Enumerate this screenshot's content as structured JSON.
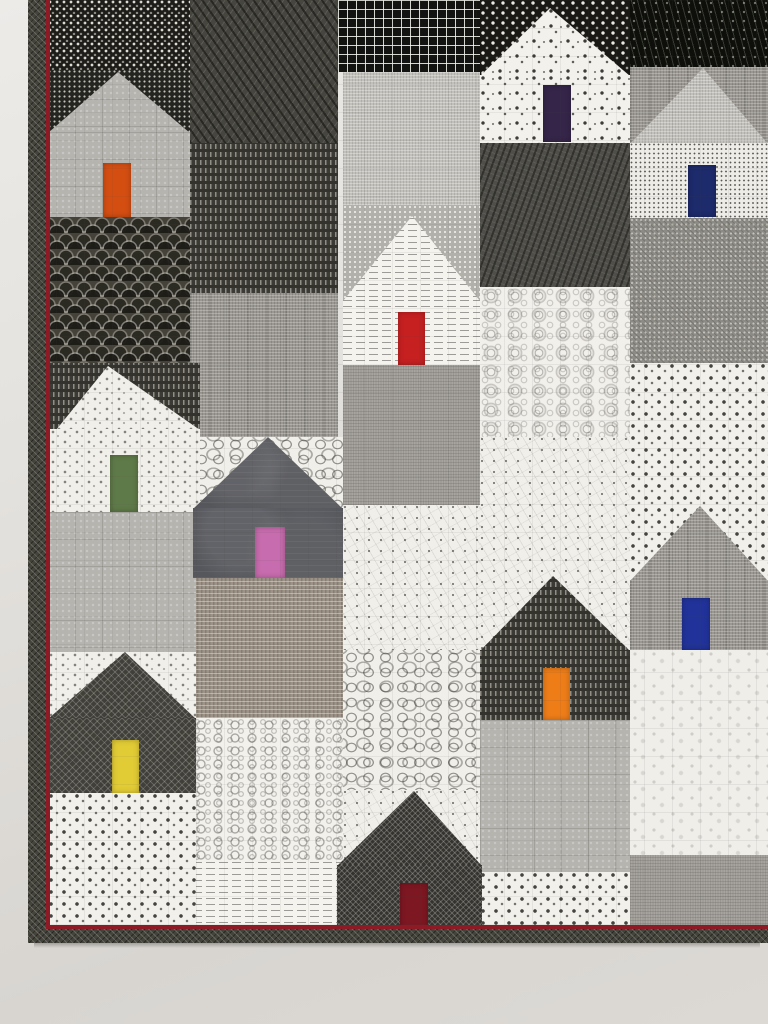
{
  "scene": {
    "subject": "Modern patchwork quilt of house blocks hanging on a gallery wall",
    "medium": "photograph",
    "houses_count": 10
  },
  "wall": {
    "top_color": "#edebe8",
    "bottom_color": "#d8d5d1"
  },
  "quilt": {
    "area": {
      "x": 28,
      "y": 0,
      "w": 740,
      "h": 943
    },
    "binding_color": "#45443c",
    "accent_color": "#8e1a26",
    "bands": [
      {
        "x": 28,
        "y": 0,
        "w": 18,
        "h": 943,
        "type": "binding",
        "name": "binding-left"
      },
      {
        "x": 28,
        "y": 929,
        "w": 740,
        "h": 14,
        "type": "binding",
        "name": "binding-bottom"
      },
      {
        "x": 46,
        "y": 0,
        "w": 4,
        "h": 929,
        "type": "accent",
        "name": "accent-line-left"
      },
      {
        "x": 46,
        "y": 925,
        "w": 722,
        "h": 4,
        "type": "accent",
        "name": "accent-line-bottom"
      },
      {
        "x": 34,
        "y": 943,
        "w": 726,
        "h": 5,
        "type": "shadow",
        "name": "quilt-drop-shadow"
      }
    ],
    "patches": [
      {
        "x": 630,
        "y": 0,
        "w": 138,
        "h": 67,
        "f": "bk_speck"
      },
      {
        "x": 630,
        "y": 67,
        "w": 138,
        "h": 76,
        "f": "md_linen"
      },
      {
        "x": 630,
        "y": 218,
        "w": 138,
        "h": 145,
        "f": "gray_dg"
      },
      {
        "x": 630,
        "y": 363,
        "w": 138,
        "h": 217,
        "f": "w_sqdots"
      },
      {
        "x": 630,
        "y": 650,
        "w": 138,
        "h": 205,
        "f": "w_floral"
      },
      {
        "x": 630,
        "y": 855,
        "w": 138,
        "h": 75,
        "f": "gray_scr"
      },
      {
        "x": 480,
        "y": 0,
        "w": 150,
        "h": 75,
        "f": "bk_sqbig"
      },
      {
        "x": 480,
        "y": 143,
        "w": 150,
        "h": 144,
        "f": "dk_slab"
      },
      {
        "x": 480,
        "y": 287,
        "w": 150,
        "h": 150,
        "f": "w_swirl"
      },
      {
        "x": 480,
        "y": 437,
        "w": 150,
        "h": 215,
        "f": "w_tri"
      },
      {
        "x": 480,
        "y": 720,
        "w": 150,
        "h": 152,
        "f": "lt_grid"
      },
      {
        "x": 480,
        "y": 872,
        "w": 150,
        "h": 58,
        "f": "w_sqdots"
      },
      {
        "x": 338,
        "y": 0,
        "w": 142,
        "h": 72,
        "f": "bk_grid"
      },
      {
        "x": 343,
        "y": 72,
        "w": 137,
        "h": 133,
        "f": "lt_linen"
      },
      {
        "x": 343,
        "y": 205,
        "w": 137,
        "h": 97,
        "f": "gray_dots"
      },
      {
        "x": 343,
        "y": 365,
        "w": 137,
        "h": 140,
        "f": "gray_scr"
      },
      {
        "x": 343,
        "y": 505,
        "w": 137,
        "h": 145,
        "f": "w_tri"
      },
      {
        "x": 343,
        "y": 650,
        "w": 137,
        "h": 143,
        "f": "w_sqout"
      },
      {
        "x": 343,
        "y": 790,
        "w": 137,
        "h": 80,
        "f": "w_tri"
      },
      {
        "x": 190,
        "y": 0,
        "w": 148,
        "h": 143,
        "f": "dk_x"
      },
      {
        "x": 190,
        "y": 143,
        "w": 148,
        "h": 150,
        "f": "dk_dash"
      },
      {
        "x": 190,
        "y": 293,
        "w": 148,
        "h": 144,
        "f": "md_linen"
      },
      {
        "x": 193,
        "y": 437,
        "w": 150,
        "h": 73,
        "f": "w_sqout"
      },
      {
        "x": 193,
        "y": 578,
        "w": 150,
        "h": 140,
        "f": "taupe"
      },
      {
        "x": 193,
        "y": 718,
        "w": 150,
        "h": 144,
        "f": "w_ovals"
      },
      {
        "x": 193,
        "y": 862,
        "w": 150,
        "h": 71,
        "f": "w_text"
      },
      {
        "x": 48,
        "y": 0,
        "w": 142,
        "h": 70,
        "f": "bk_sq"
      },
      {
        "x": 48,
        "y": 70,
        "w": 142,
        "h": 62,
        "f": "bk_dot"
      },
      {
        "x": 48,
        "y": 217,
        "w": 142,
        "h": 146,
        "f": "fan"
      },
      {
        "x": 48,
        "y": 363,
        "w": 152,
        "h": 66,
        "f": "dk_dash"
      },
      {
        "x": 48,
        "y": 512,
        "w": 148,
        "h": 140,
        "f": "lt_grid"
      },
      {
        "x": 48,
        "y": 652,
        "w": 148,
        "h": 68,
        "f": "wspeck"
      },
      {
        "x": 48,
        "y": 793,
        "w": 148,
        "h": 140,
        "f": "w_sqdots"
      }
    ],
    "houses": [
      {
        "id": "house-orange-door",
        "door_color": "#d44e12",
        "roof": {
          "left": 48,
          "right": 190,
          "apex_x": 118,
          "apex_y": 72,
          "base_y": 132,
          "f": "lt_grid"
        },
        "body": {
          "x": 48,
          "y": 132,
          "w": 142,
          "h": 85,
          "f": "lt_grid"
        },
        "door": {
          "x": 103,
          "y": 163,
          "w": 28,
          "h": 54
        }
      },
      {
        "id": "house-green-door",
        "door_color": "#5f7a49",
        "roof": {
          "left": 56,
          "right": 200,
          "apex_x": 108,
          "apex_y": 366,
          "base_y": 429,
          "f": "wspeck"
        },
        "body": {
          "x": 50,
          "y": 429,
          "w": 150,
          "h": 83,
          "f": "wspeck"
        },
        "door": {
          "x": 110,
          "y": 455,
          "w": 28,
          "h": 57
        }
      },
      {
        "id": "house-yellow-door",
        "door_color": "#e2cc35",
        "roof": {
          "left": 48,
          "right": 196,
          "apex_x": 125,
          "apex_y": 652,
          "base_y": 718,
          "f": "dk_dia"
        },
        "body": {
          "x": 48,
          "y": 718,
          "w": 148,
          "h": 75,
          "f": "dk_dia"
        },
        "door": {
          "x": 112,
          "y": 740,
          "w": 27,
          "h": 53
        }
      },
      {
        "id": "house-pink-door",
        "door_color": "#c76cae",
        "roof": {
          "left": 193,
          "right": 343,
          "apex_x": 268,
          "apex_y": 437,
          "base_y": 508,
          "f": "char_leaf"
        },
        "body": {
          "x": 193,
          "y": 508,
          "w": 150,
          "h": 70,
          "f": "char_leaf"
        },
        "door": {
          "x": 255,
          "y": 527,
          "w": 30,
          "h": 51
        }
      },
      {
        "id": "house-red-door",
        "door_color": "#c62021",
        "roof": {
          "left": 343,
          "right": 480,
          "apex_x": 412,
          "apex_y": 216,
          "base_y": 300,
          "f": "w_text"
        },
        "body": {
          "x": 343,
          "y": 300,
          "w": 137,
          "h": 65,
          "f": "w_text"
        },
        "door": {
          "x": 398,
          "y": 312,
          "w": 27,
          "h": 53
        }
      },
      {
        "id": "house-maroon-door",
        "door_color": "#7d1722",
        "roof": {
          "left": 337,
          "right": 482,
          "apex_x": 414,
          "apex_y": 791,
          "base_y": 865,
          "f": "dk_dia2"
        },
        "body": {
          "x": 337,
          "y": 865,
          "w": 145,
          "h": 64,
          "f": "dk_dia2"
        },
        "door": {
          "x": 400,
          "y": 883,
          "w": 28,
          "h": 46
        }
      },
      {
        "id": "house-eggplant-door",
        "door_color": "#352549",
        "roof": {
          "left": 480,
          "right": 630,
          "apex_x": 550,
          "apex_y": 8,
          "base_y": 75,
          "f": "w_dotsq"
        },
        "body": {
          "x": 480,
          "y": 75,
          "w": 150,
          "h": 68,
          "f": "w_dotsq"
        },
        "door": {
          "x": 543,
          "y": 85,
          "w": 28,
          "h": 57
        }
      },
      {
        "id": "house-orange2-door",
        "door_color": "#ee7d18",
        "roof": {
          "left": 480,
          "right": 630,
          "apex_x": 553,
          "apex_y": 576,
          "base_y": 650,
          "f": "dk_dash"
        },
        "body": {
          "x": 480,
          "y": 650,
          "w": 150,
          "h": 70,
          "f": "dk_dash"
        },
        "door": {
          "x": 543,
          "y": 668,
          "w": 27,
          "h": 52
        }
      },
      {
        "id": "house-navy-door",
        "door_color": "#1d2a6b",
        "roof": {
          "left": 630,
          "right": 768,
          "apex_x": 703,
          "apex_y": 68,
          "base_y": 143,
          "f": "lt_linen"
        },
        "body": {
          "x": 630,
          "y": 143,
          "w": 138,
          "h": 75,
          "f": "w_dotfine"
        },
        "door": {
          "x": 688,
          "y": 165,
          "w": 28,
          "h": 52
        }
      },
      {
        "id": "house-royal-door",
        "door_color": "#21339b",
        "roof": {
          "left": 630,
          "right": 768,
          "apex_x": 700,
          "apex_y": 506,
          "base_y": 580,
          "f": "md_linen"
        },
        "body": {
          "x": 630,
          "y": 580,
          "w": 138,
          "h": 70,
          "f": "md_linen"
        },
        "door": {
          "x": 682,
          "y": 598,
          "w": 28,
          "h": 52
        }
      }
    ]
  },
  "fabrics": {
    "bk_sq": "black with dense white square dots",
    "bk_dot": "black with fine white dots",
    "fan": "charcoal clamshell fan print",
    "dk_x": "dark gray diagonal crosshatch weave",
    "dk_dash": "charcoal with white vertical dashes",
    "md_linen": "medium gray linen crosshatch",
    "lt_linen": "light gray linen crosshatch",
    "lt_grid": "pale gray with quilted grid",
    "gray_dots": "gray with tiny white dots",
    "gray_scr": "gray scratchy texture",
    "taupe": "taupe dense weave",
    "w_sqout": "white with black square outlines",
    "w_ovals": "white with concentric oval rings",
    "w_text": "white newsprint text rows",
    "bk_grid": "black with white grid lines",
    "w_tri": "white constellation dot-and-line print",
    "dk_slab": "dark gray diagonal slub weave",
    "w_swirl": "white with gray swirl circles",
    "bk_sqbig": "black with bold white square dots",
    "w_dotsq": "white with scattered black squares",
    "w_sqdots": "white with small black squares and dots",
    "bk_speck": "near-black with white streak speckle",
    "w_dotfine": "white with very fine black dots",
    "gray_dg": "gray diagonal dotted weave",
    "w_floral": "white with faint gray sprigs",
    "char_leaf": "charcoal tonal leaf batik",
    "dk_dia": "dark gray diamond lattice",
    "dk_dia2": "black diamond lattice",
    "wspeck": "white with black speckles"
  }
}
